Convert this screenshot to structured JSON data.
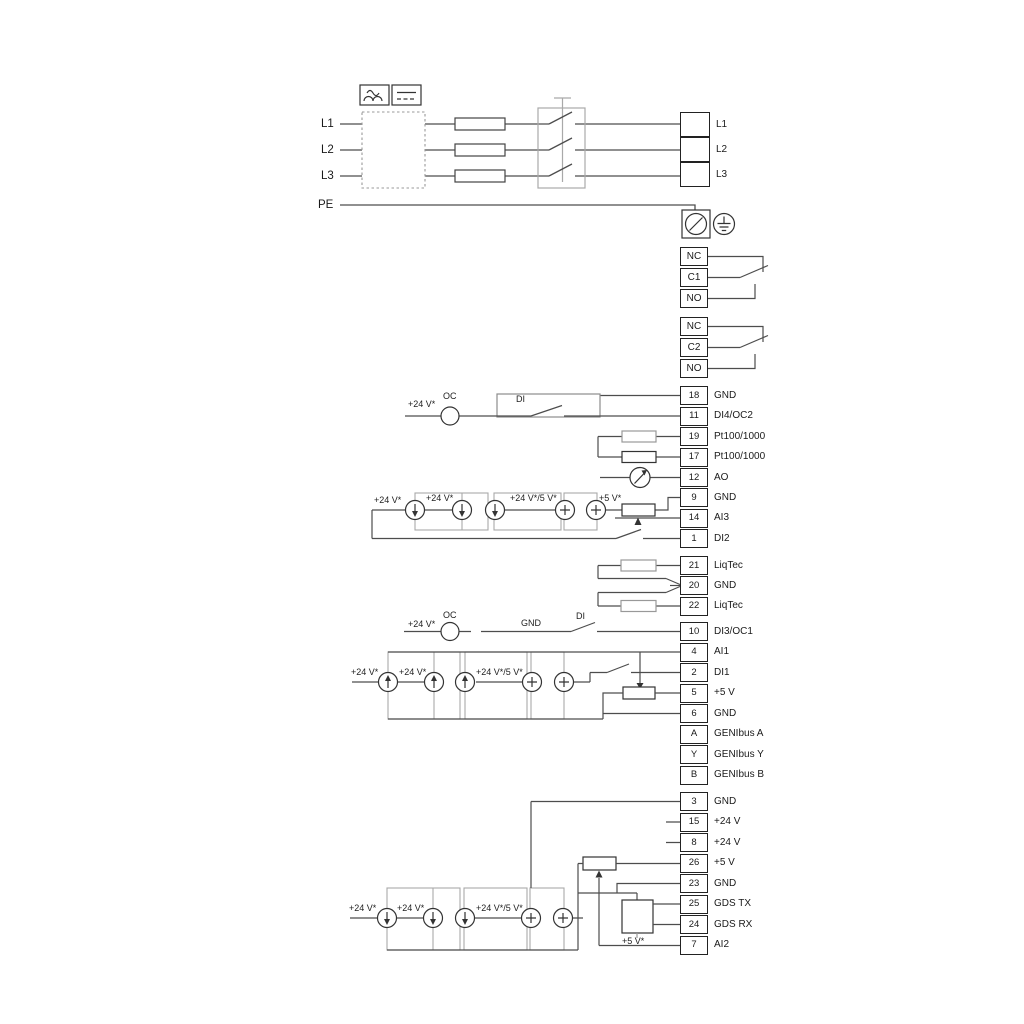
{
  "power": {
    "input_labels": [
      "L1",
      "L2",
      "L3",
      "PE"
    ],
    "output_block": [
      "L1",
      "L2",
      "L3"
    ]
  },
  "relay_blocks": [
    [
      "NC",
      "C1",
      "NO"
    ],
    [
      "NC",
      "C2",
      "NO"
    ]
  ],
  "io_terminals": [
    {
      "pin": "18",
      "label": "GND"
    },
    {
      "pin": "11",
      "label": "DI4/OC2"
    },
    {
      "pin": "19",
      "label": "Pt100/1000"
    },
    {
      "pin": "17",
      "label": "Pt100/1000"
    },
    {
      "pin": "12",
      "label": "AO"
    },
    {
      "pin": "9",
      "label": "GND"
    },
    {
      "pin": "14",
      "label": "AI3"
    },
    {
      "pin": "1",
      "label": "DI2"
    },
    {
      "pin": "21",
      "label": "LiqTec"
    },
    {
      "pin": "20",
      "label": "GND"
    },
    {
      "pin": "22",
      "label": "LiqTec"
    },
    {
      "pin": "10",
      "label": "DI3/OC1"
    },
    {
      "pin": "4",
      "label": "AI1"
    },
    {
      "pin": "2",
      "label": "DI1"
    },
    {
      "pin": "5",
      "label": "+5 V"
    },
    {
      "pin": "6",
      "label": "GND"
    },
    {
      "pin": "A",
      "label": "GENIbus A"
    },
    {
      "pin": "Y",
      "label": "GENIbus Y"
    },
    {
      "pin": "B",
      "label": "GENIbus B"
    },
    {
      "pin": "3",
      "label": "GND"
    },
    {
      "pin": "15",
      "label": "+24 V"
    },
    {
      "pin": "8",
      "label": "+24 V"
    },
    {
      "pin": "26",
      "label": "+5 V"
    },
    {
      "pin": "23",
      "label": "GND"
    },
    {
      "pin": "25",
      "label": "GDS TX"
    },
    {
      "pin": "24",
      "label": "GDS RX"
    },
    {
      "pin": "7",
      "label": "AI2"
    }
  ],
  "annotations": [
    {
      "text": "+24 V*"
    },
    {
      "text": "OC"
    },
    {
      "text": "DI"
    },
    {
      "text": "+24 V*"
    },
    {
      "text": "+24 V*"
    },
    {
      "text": "+24 V*/5 V*"
    },
    {
      "text": "+5 V*"
    },
    {
      "text": "+24 V*"
    },
    {
      "text": "OC"
    },
    {
      "text": "GND"
    },
    {
      "text": "DI"
    },
    {
      "text": "+24 V*"
    },
    {
      "text": "+24 V*"
    },
    {
      "text": "+24 V*/5 V*"
    },
    {
      "text": "+24 V*"
    },
    {
      "text": "+24 V*"
    },
    {
      "text": "+24 V*/5 V*"
    },
    {
      "text": "+5 V*"
    }
  ],
  "colors": {
    "wire": "#4d4d4d",
    "structure_gray": "#a9a9a9",
    "terminal_border": "#222222"
  }
}
